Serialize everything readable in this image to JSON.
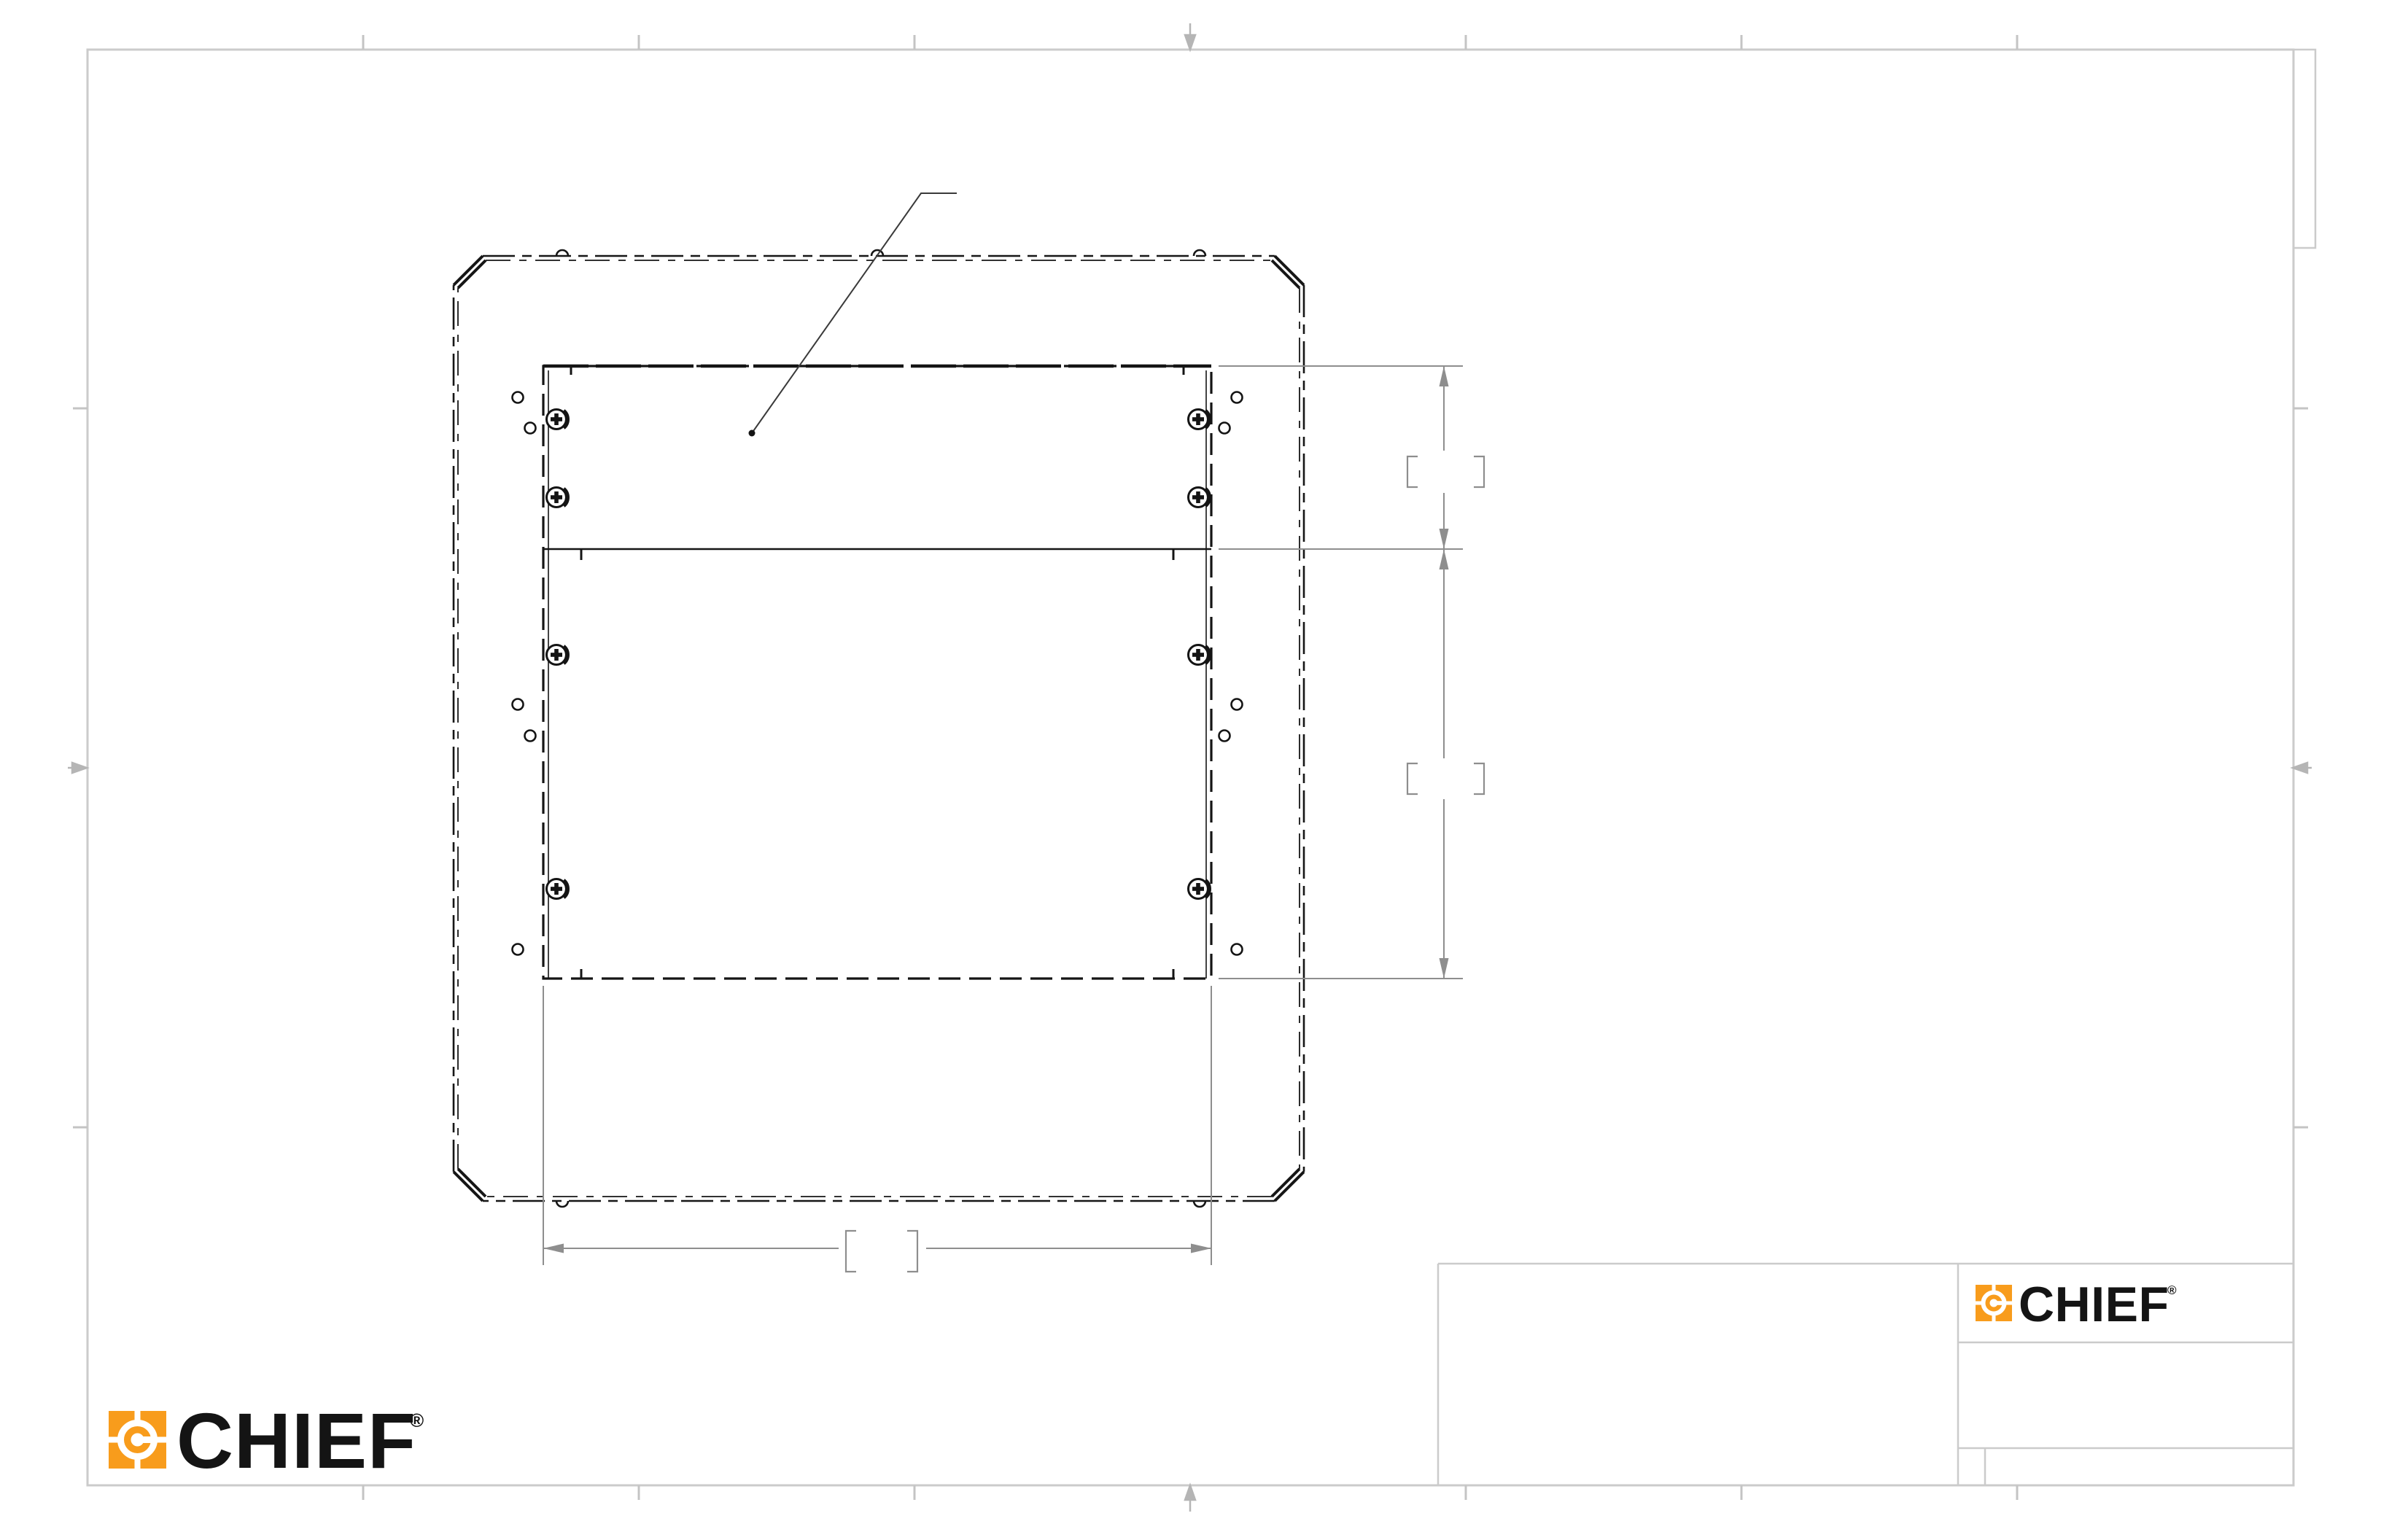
{
  "sheet": {
    "type": "engineering-drawing",
    "description": "Chief flat-panel interface bracket mounting pattern drawing, rear view, untitled sheet",
    "background_color": "#ffffff",
    "border_color": "#cbcbcb",
    "object_line_color": "#141414",
    "dimension_line_color": "#8e8e8e"
  },
  "logo": {
    "text": "CHIEF",
    "registered": "®",
    "orange": "#F89C1C",
    "text_color": "#141414"
  },
  "dimensions": {
    "right_upper": {
      "value": "",
      "bracket_open": "[",
      "bracket_close": "]",
      "orientation": "vertical"
    },
    "right_lower": {
      "value": "",
      "bracket_open": "[",
      "bracket_close": "]",
      "orientation": "vertical"
    },
    "bottom_width": {
      "value": "",
      "bracket_open": "[",
      "bracket_close": "]",
      "orientation": "horizontal"
    }
  },
  "title_block": {
    "notes_cell": "",
    "logo_cell": "CHIEF",
    "middle_cell": "",
    "bottom_left_cell": "",
    "bottom_right_cell": ""
  },
  "leader_note": ""
}
